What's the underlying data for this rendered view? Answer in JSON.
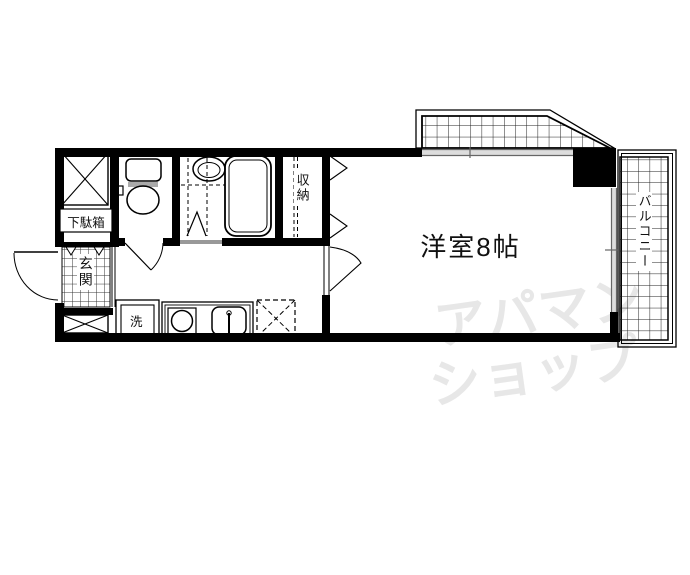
{
  "plan": {
    "title": "1K apartment floor plan",
    "labels": {
      "main_room": "洋室8帖",
      "balcony": "バルコニー",
      "storage": "収納",
      "entrance": "玄関",
      "shoe_cabinet": "下駄箱",
      "washer": "洗"
    },
    "watermark": {
      "line1": "アパマン",
      "line2": "ショップ"
    },
    "icons": {
      "toilet": "toilet-icon",
      "bathtub": "bathtub-icon",
      "washbasin": "washbasin-icon",
      "stove": "stove-burner-icon",
      "kitchen_sink": "kitchen-sink-icon",
      "refrigerator_space": "refrigerator-dashed-box",
      "pipe_space": "crossed-box-icon",
      "entrance_door": "door-swing-arc",
      "room_door": "door-swing-arc",
      "closet_doors": "hinged-door-triangles"
    },
    "colors": {
      "wall": "#000000",
      "window_line": "#666666",
      "window_fill": "#dddddd",
      "threshold": "#999999",
      "tile_line": "#222222",
      "watermark": "#e7e7e7",
      "background": "#ffffff"
    }
  }
}
